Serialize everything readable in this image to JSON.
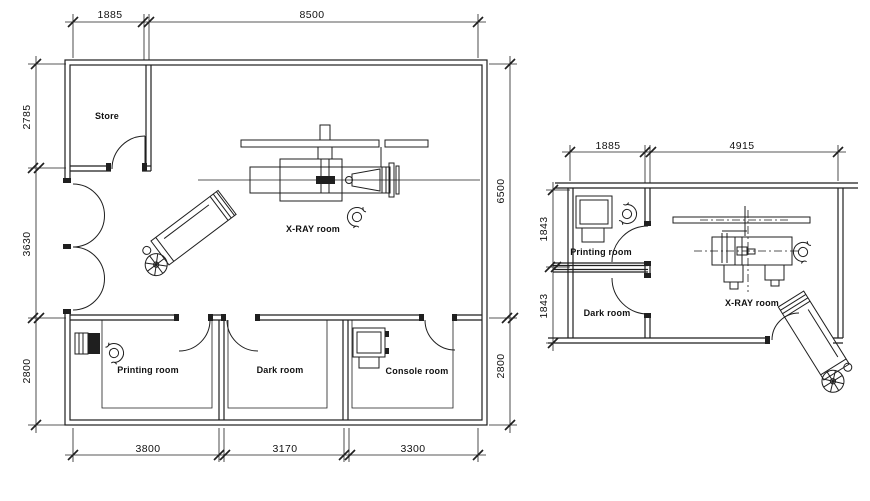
{
  "meta": {
    "drawing_type": "architectural floor plan",
    "background": "#ffffff",
    "line_color": "#1f1f1f",
    "text_color": "#111111"
  },
  "left_plan": {
    "rooms": {
      "store": "Store",
      "xray": "X-RAY room",
      "printing": "Printing room",
      "dark": "Dark room",
      "console": "Console room"
    },
    "dims": {
      "top": [
        "1885",
        "8500"
      ],
      "left": [
        "2785",
        "3630",
        "2800"
      ],
      "right": [
        "6500",
        "2800"
      ],
      "bottom": [
        "3800",
        "3170",
        "3300"
      ]
    },
    "symbols": [
      "double-swing-door",
      "patient-stretcher",
      "x-ray-table",
      "ceiling-tube-rail",
      "collimator-cone",
      "chest-stand",
      "operator-figure",
      "film-printer",
      "technician-figure",
      "console-desk"
    ]
  },
  "right_plan": {
    "rooms": {
      "printing": "Printing room",
      "dark": "Dark room",
      "xray": "X-RAY room"
    },
    "dims": {
      "top": [
        "1885",
        "4915"
      ],
      "left": [
        "1843",
        "1843"
      ]
    },
    "symbols": [
      "film-printer",
      "technician-figure",
      "ceiling-tube-rail",
      "x-ray-table",
      "operator-figure",
      "patient-stretcher"
    ]
  }
}
